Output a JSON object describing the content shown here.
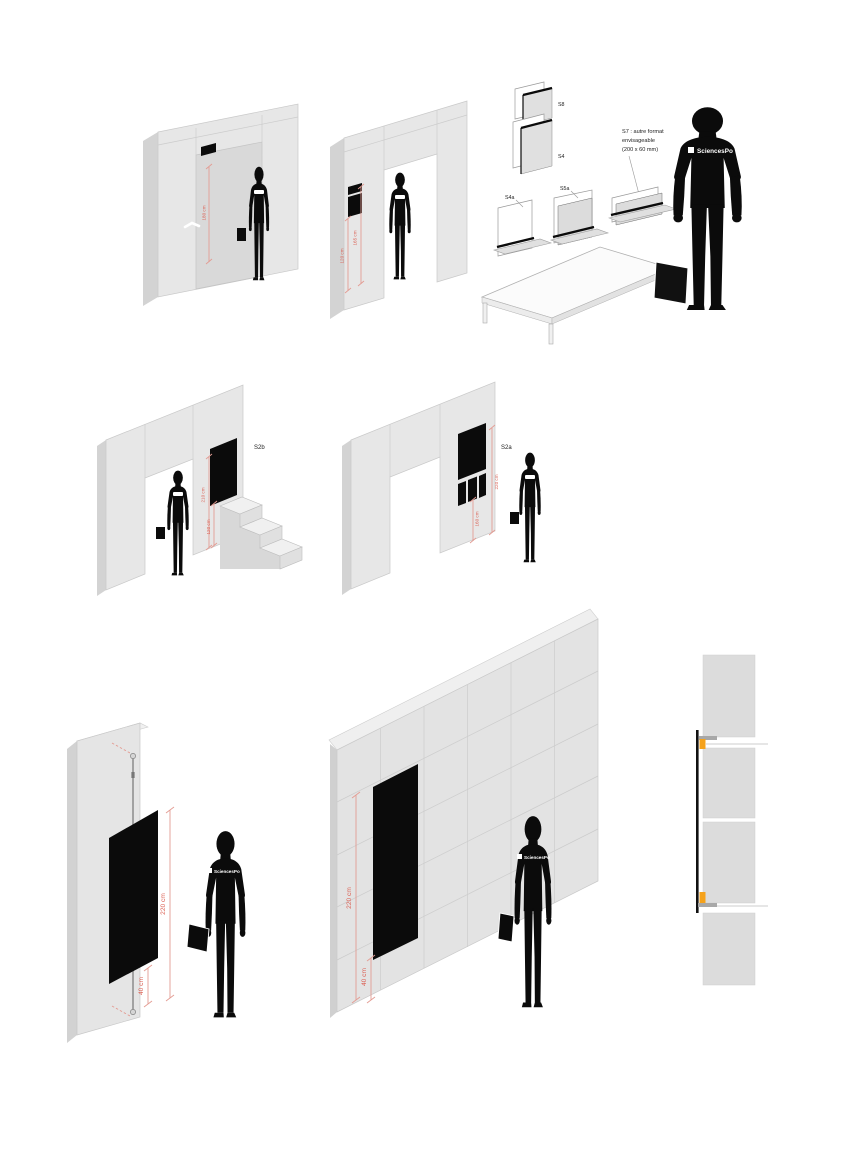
{
  "meta": {
    "title": "Signage placement diagrams"
  },
  "labels": {
    "s8": "S8",
    "s4": "S4",
    "s4a": "S4a",
    "s5a": "S5a",
    "s2b": "S2b",
    "s2a": "S2a"
  },
  "note_s7": {
    "line1": "S7 : autre format",
    "line2": "envisageable",
    "line3": "(200 x 60 mm)"
  },
  "shirt_logo": "SciencesPo",
  "dimensions": {
    "door_sign_height": "180 cm",
    "portal_sign_bottom": "120 cm",
    "portal_sign_top": "165 cm",
    "s2b_top": "210 cm",
    "s2b_bottom": "120 cm",
    "s2a_top": "220 cm",
    "s2a_bottom": "160 cm",
    "pole_panel_height": "220 cm",
    "pole_panel_bottom": "40 cm",
    "wall_panel_height": "220 cm",
    "wall_panel_bottom": "40 cm"
  },
  "colors": {
    "dimension_red_text": "#DB5E51",
    "dimension_red_line": "#E39C93",
    "bracket_orange": "#F5A21B",
    "panel_black": "#0B0B0B",
    "wall_gray": "#E6E6E6",
    "wall_side_gray": "#D2D2D2"
  }
}
